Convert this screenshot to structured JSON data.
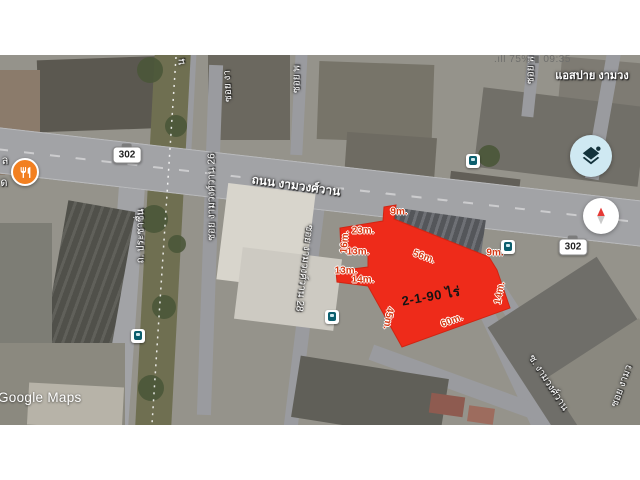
{
  "status_bar": {
    "text": ".ıll 75% ▮ 09:35"
  },
  "map": {
    "watermark": "Google Maps",
    "labels": [
      {
        "text": "ถนน งามวงศ์วาน",
        "x": 296,
        "y": 186,
        "rot": 8,
        "size": 12,
        "weight": 600
      },
      {
        "text": "ถ. ประชาชื่น",
        "x": 141,
        "y": 236,
        "rot": -90,
        "size": 10
      },
      {
        "text": "ซอย งามวงศ์วาน 26",
        "x": 212,
        "y": 197,
        "rot": -90,
        "size": 10
      },
      {
        "text": "ซอย งามวงศ์วาน 28",
        "x": 304,
        "y": 268,
        "rot": 97,
        "size": 10
      },
      {
        "text": "ซ. งามวงศ์วาน",
        "x": 548,
        "y": 383,
        "rot": 57,
        "size": 10
      },
      {
        "text": "ซอย งามว",
        "x": 622,
        "y": 386,
        "rot": -70,
        "size": 10
      },
      {
        "text": "ซอย งา",
        "x": 228,
        "y": 86,
        "rot": -93,
        "size": 10
      },
      {
        "text": "ซอย พ",
        "x": 297,
        "y": 79,
        "rot": -90,
        "size": 10
      },
      {
        "text": "ซอย พ",
        "x": 531,
        "y": 70,
        "rot": -90,
        "size": 10
      },
      {
        "text": "น",
        "x": 182,
        "y": 62,
        "rot": -90,
        "size": 10
      },
      {
        "text": "ล",
        "x": 5,
        "y": 160,
        "rot": 0,
        "size": 11
      },
      {
        "text": "ด",
        "x": 4,
        "y": 182,
        "rot": 0,
        "size": 11
      },
      {
        "text": "แอสปาย งามวง",
        "x": 592,
        "y": 75,
        "rot": 0,
        "size": 11,
        "weight": 700
      }
    ],
    "route_badges": [
      {
        "text": "302",
        "x": 127,
        "y": 155
      },
      {
        "text": "302",
        "x": 573,
        "y": 247
      }
    ],
    "bus_stops": [
      {
        "x": 473,
        "y": 161
      },
      {
        "x": 508,
        "y": 247
      },
      {
        "x": 138,
        "y": 336
      },
      {
        "x": 332,
        "y": 317
      }
    ],
    "poi": {
      "name": "restaurant",
      "x": 25,
      "y": 172,
      "color": "#f28021"
    }
  },
  "parcel": {
    "fill": "#ee2b1a",
    "outline_points": "384,207 396,205 394,219 489,257 497,270 510,308 402,347 368,286 337,282 336,271 368,267 368,255 341,251 340,228 383,221",
    "area_label": {
      "text": "2-1-90 ไร่",
      "x": 431,
      "y": 296,
      "rot": -10
    },
    "measurements": [
      {
        "text": "9m.",
        "x": 399,
        "y": 212,
        "rot": 0
      },
      {
        "text": "23m.",
        "x": 363,
        "y": 231,
        "rot": 0
      },
      {
        "text": "16m.",
        "x": 345,
        "y": 242,
        "rot": -85
      },
      {
        "text": "13m.",
        "x": 358,
        "y": 252,
        "rot": 0
      },
      {
        "text": "13m.",
        "x": 346,
        "y": 271,
        "rot": 0
      },
      {
        "text": "14m.",
        "x": 363,
        "y": 280,
        "rot": 0
      },
      {
        "text": "56m.",
        "x": 424,
        "y": 257,
        "rot": 20
      },
      {
        "text": "9m.",
        "x": 495,
        "y": 253,
        "rot": 0
      },
      {
        "text": "14m.",
        "x": 500,
        "y": 293,
        "rot": -80
      },
      {
        "text": "45m.",
        "x": 388,
        "y": 318,
        "rot": 100
      },
      {
        "text": "60m.",
        "x": 452,
        "y": 321,
        "rot": -20
      }
    ],
    "measurement_color": "#d63a14"
  },
  "controls": {
    "layers_button": "layers",
    "compass_button": "compass"
  }
}
